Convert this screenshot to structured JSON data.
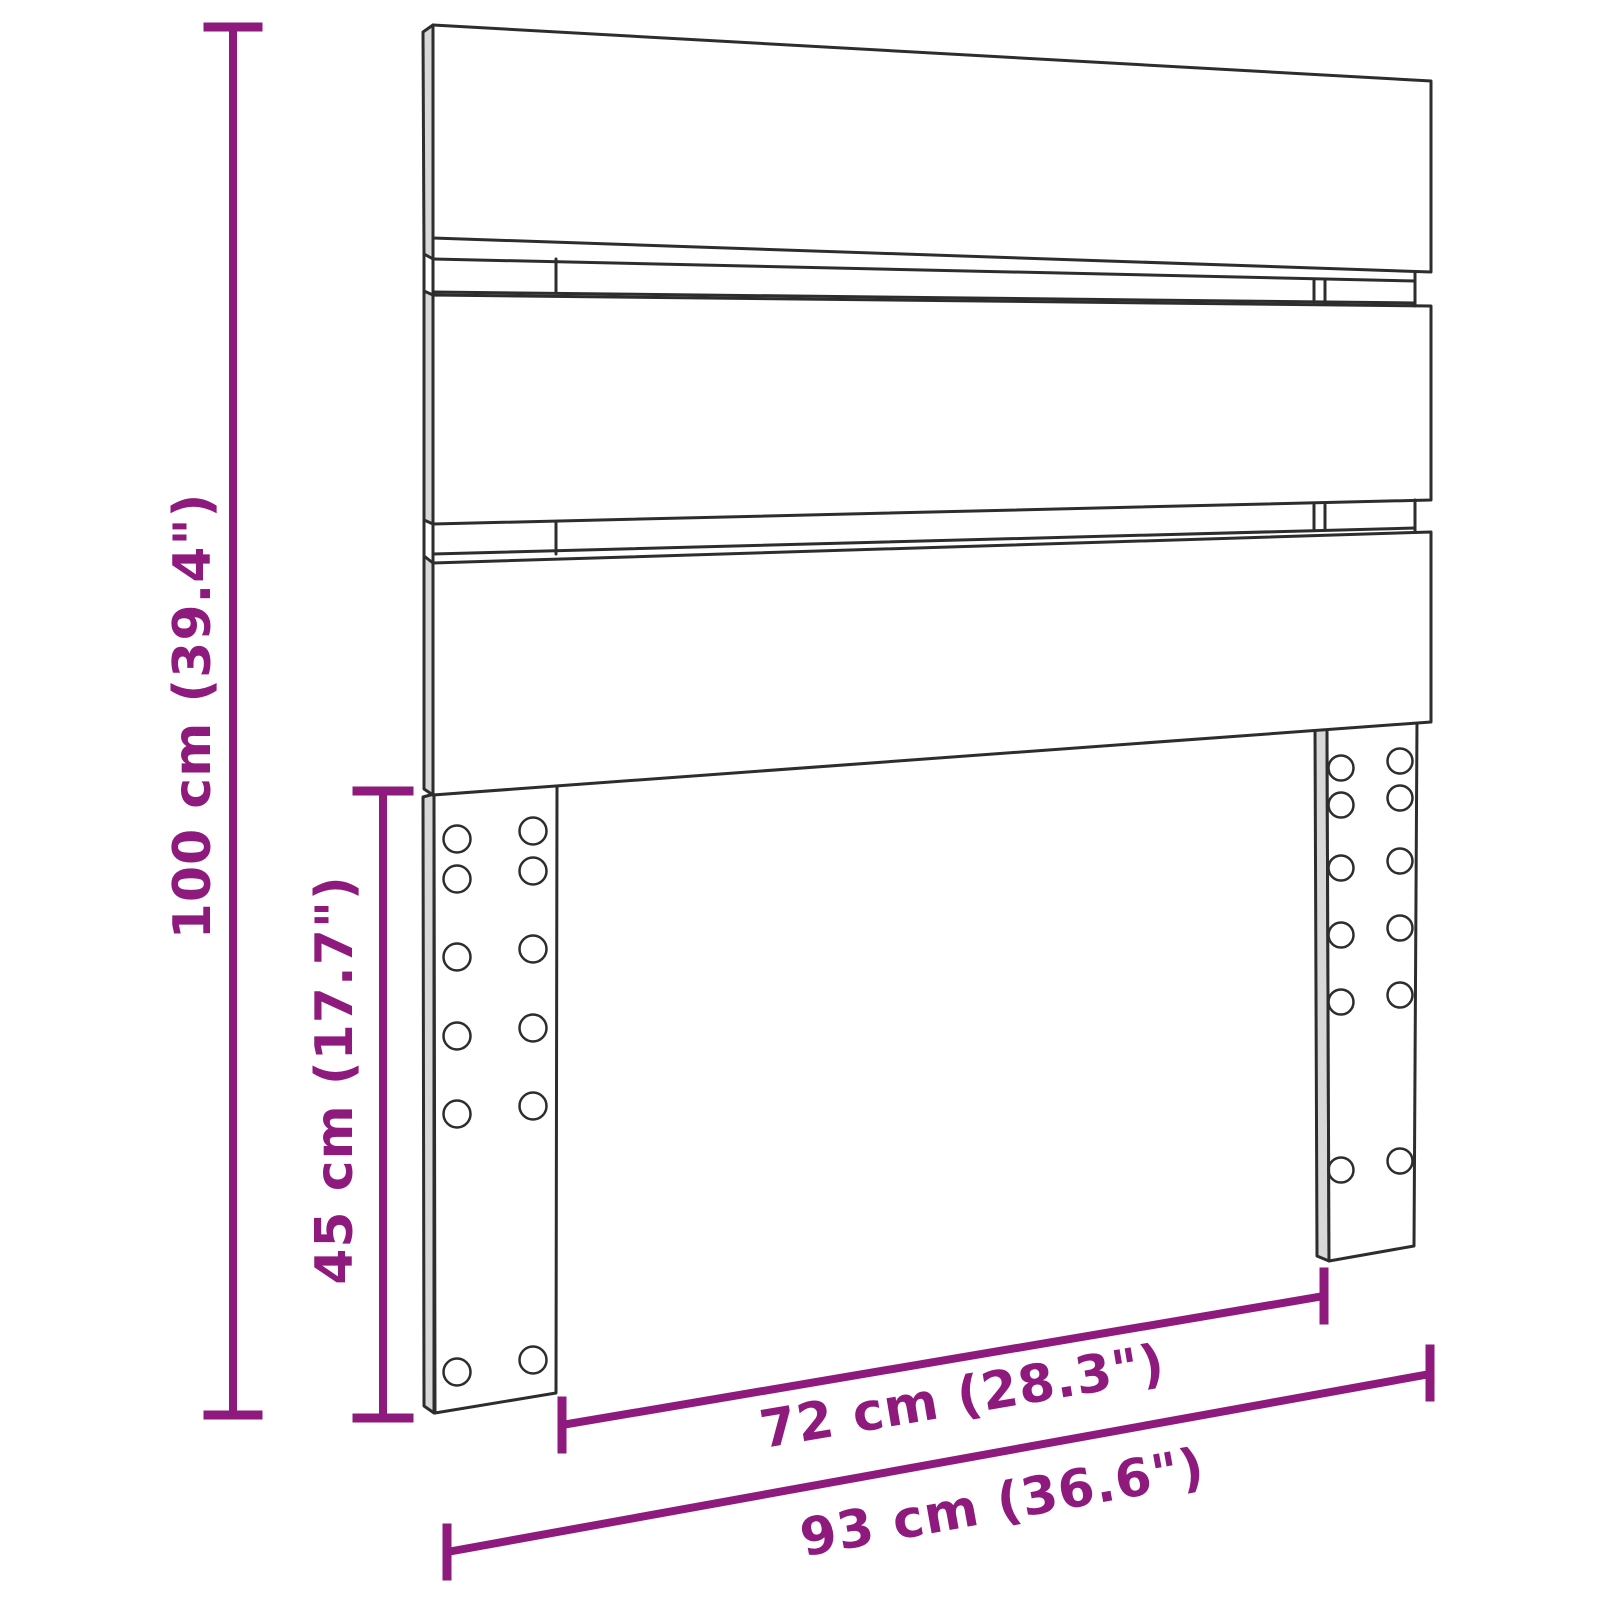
{
  "diagram": {
    "dimension_labels": {
      "total_height": "100 cm (39.4\")",
      "leg_height": "45 cm (17.7\")",
      "inner_width": "72 cm (28.3\")",
      "total_width": "93 cm (36.6\")"
    },
    "colors": {
      "dimension": "#8F1A7D",
      "drawing": "#2D2D2D",
      "background": "#FFFFFF"
    }
  }
}
